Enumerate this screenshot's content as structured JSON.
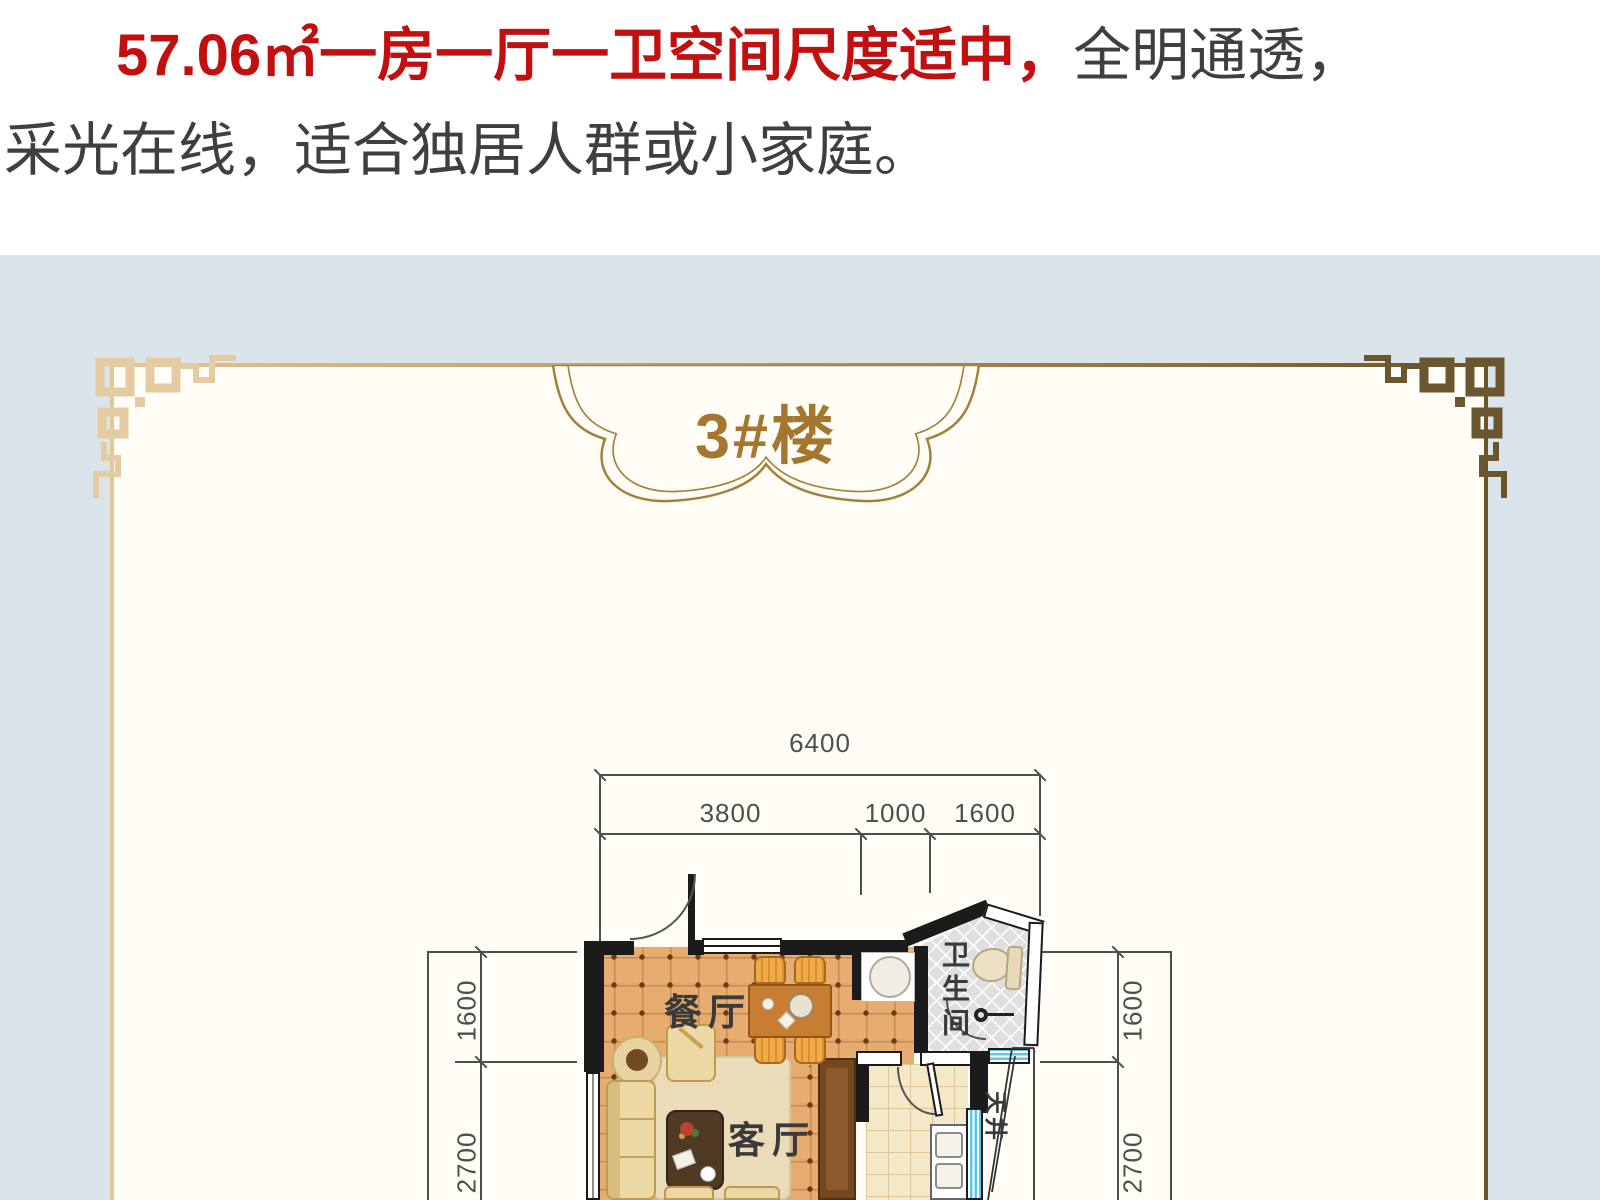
{
  "headline": {
    "highlight": "57.06㎡一房一厅一卫空间尺度适中，",
    "normal": "全明通透，",
    "line2": "采光在线，适合独居人群或小家庭。"
  },
  "badge": {
    "label": "3#楼"
  },
  "floorplan": {
    "dims": {
      "total": "6400",
      "segments": [
        "3800",
        "1000",
        "1600"
      ],
      "left": [
        "1600",
        "2700"
      ],
      "right": [
        "1600",
        "2700"
      ]
    },
    "labels": {
      "dining": "餐厅",
      "living": "客厅",
      "bathroom": "卫生间",
      "lightwell": "天井"
    }
  },
  "colors": {
    "accent-red": "#c21010",
    "text-dark": "#3f3f3f",
    "panel-bg": "#dbe4ea",
    "frame-inner": "#fffdf6",
    "gold-light": "#e3c795",
    "gold-mid": "#b08b52",
    "gold-dark": "#6b5427",
    "badge-text": "#a5762e",
    "wall": "#1b1b1b",
    "dim": "#4e4e4e",
    "floor-orange": "#e7ad70",
    "rug": "#eadcb8",
    "tile-cream": "#f4e8c8",
    "bath-gray": "#dfdee1",
    "window-blue": "#5cc6e8",
    "wood": "#c77e33",
    "furniture": "#ecd8a4"
  }
}
